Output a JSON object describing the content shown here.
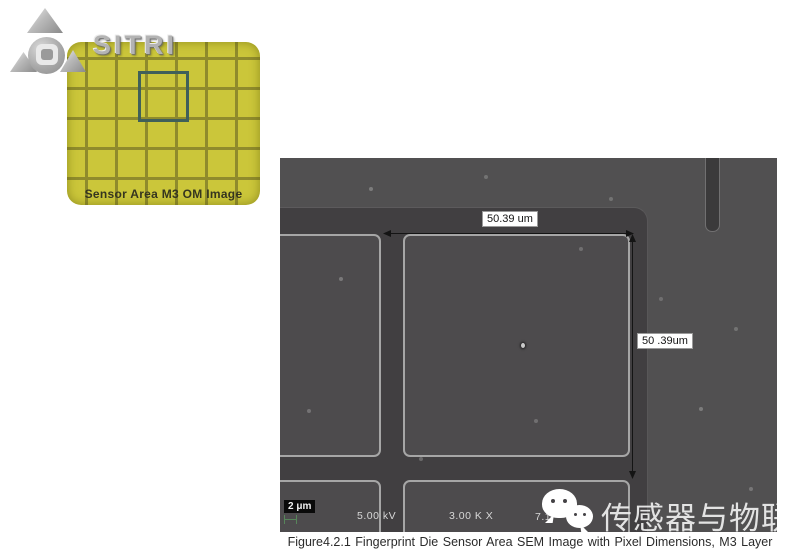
{
  "logo": {
    "brand": "SITRI"
  },
  "om_inset": {
    "caption": "Sensor Area M3 OM Image",
    "colors": {
      "fill": "#cbc63a",
      "grid": "#8f8b2c",
      "roi_outline": "#40605a"
    }
  },
  "sem_image": {
    "dim_horizontal": "50.39 um",
    "dim_vertical": "50 .39um",
    "scale_bar": "2 μm",
    "voltage": "5.00 kV",
    "magnification": "3.00 K X",
    "working_distance": "7.1",
    "colors": {
      "field": "#515051",
      "trench": "#413f41",
      "pixel_square": "#4d4b4d",
      "edge_highlight": "#a6a6a6"
    }
  },
  "watermark": {
    "icon": "wechat-icon",
    "text": "传感器与物联网"
  },
  "figure_caption": "Figure4.2.1 Fingerprint Die Sensor Area SEM Image with Pixel Dimensions, M3 Layer"
}
